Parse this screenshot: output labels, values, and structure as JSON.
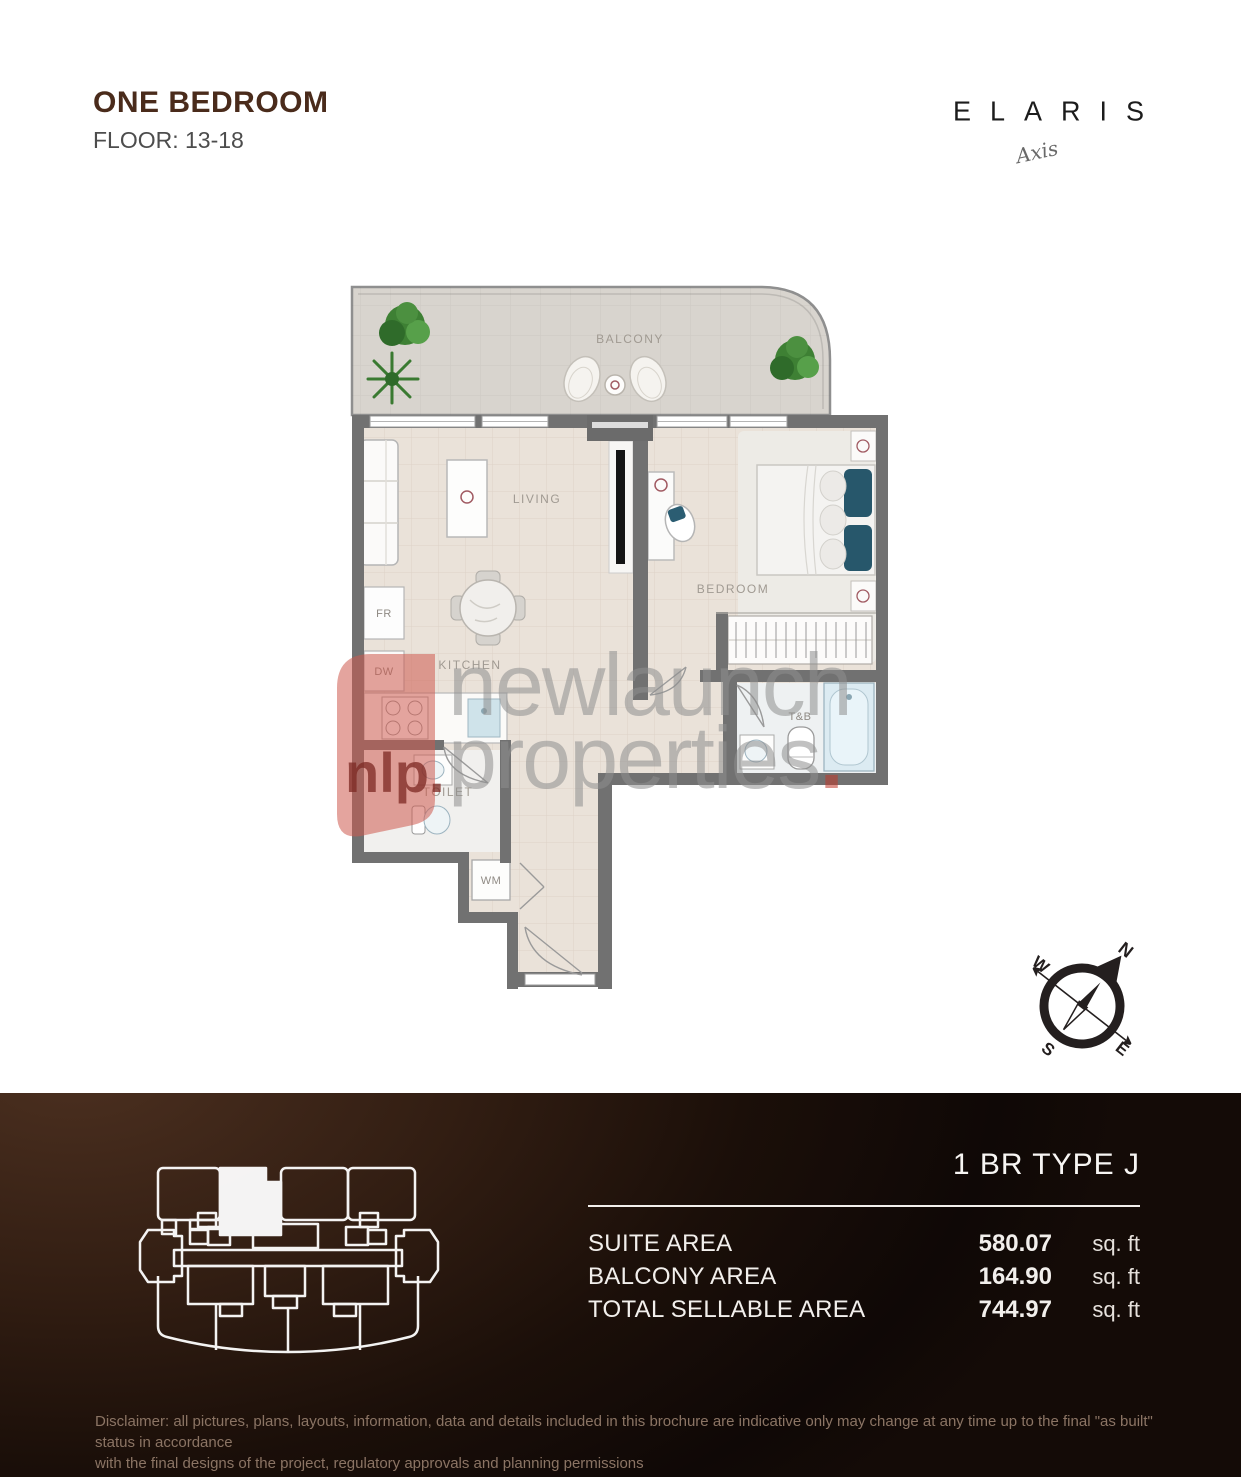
{
  "header": {
    "title": "ONE BEDROOM",
    "floor": "FLOOR: 13-18",
    "brand": "ELARIS",
    "brand_sub": "Axis"
  },
  "floor_plan": {
    "labels": {
      "balcony": "BALCONY",
      "living": "LIVING",
      "bedroom": "BEDROOM",
      "kitchen": "KITCHEN",
      "toilet": "TOILET",
      "tb": "T&B",
      "wm": "WM",
      "fr": "FR",
      "dw": "DW"
    }
  },
  "watermark": {
    "logo": "nlp.",
    "line1": "newlaunch",
    "line2": "properties",
    "dot": ".",
    "accent": "#c0392b"
  },
  "compass": {
    "n": "N",
    "e": "E",
    "s": "S",
    "w": "W"
  },
  "footer": {
    "unit_type": "1 BR TYPE J",
    "rows": [
      {
        "label": "SUITE AREA",
        "value": "580.07",
        "unit": "sq. ft"
      },
      {
        "label": "BALCONY AREA",
        "value": "164.90",
        "unit": "sq. ft"
      },
      {
        "label": "TOTAL SELLABLE AREA",
        "value": "744.97",
        "unit": "sq. ft"
      }
    ],
    "disclaimer_line1": "Disclaimer: all pictures, plans, layouts, information, data and details included in this brochure are indicative only may change at any time up to the final \"as built\" status in accordance",
    "disclaimer_line2": "with the final designs of the project, regulatory approvals and planning permissions"
  }
}
